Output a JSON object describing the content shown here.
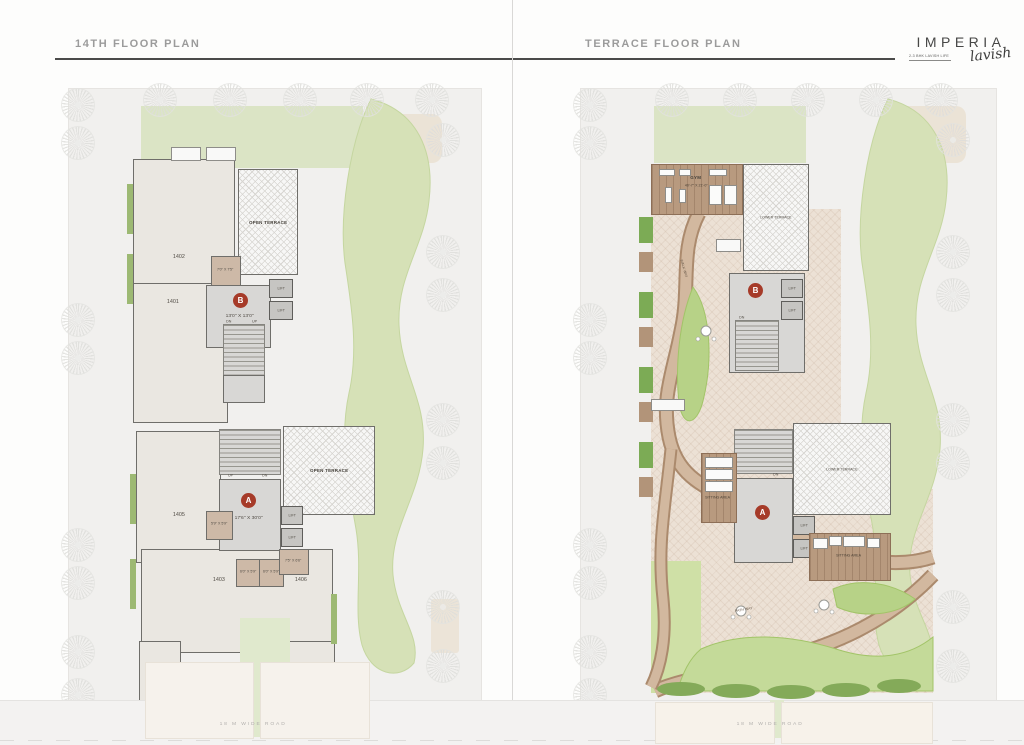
{
  "header": {
    "left_title": "14TH FLOOR PLAN",
    "right_title": "TERRACE  FLOOR PLAN"
  },
  "logo": {
    "brand": "IMPERIA",
    "tagline": "2-3 BHK LAVISH LIFE",
    "script": "lavish"
  },
  "accent_color": "#a63b29",
  "floor14": {
    "badge_b": "B",
    "badge_b_dims": "13'0\" X 13'0\"",
    "badge_a": "A",
    "badge_a_dims": "17'6\" X 30'0\"",
    "open_terrace_top": "OPEN TERRACE",
    "open_terrace_bottom": "OPEN TERRACE",
    "unit_1402": "1402",
    "unit_1401": "1401",
    "unit_1405": "1405",
    "unit_1403": "1403",
    "unit_1406": "1406",
    "store_b": "7'0\" X 7'5\"",
    "store_a": "5'9\" X 5'9\"",
    "store_c": "6'0\" X 5'9\"",
    "store_d": "6'0\" X 5'9\"",
    "store_e": "7'5\" X 6'6\"",
    "lift": "LIFT",
    "dn": "DN",
    "up": "UP",
    "road": "18 M WIDE ROAD"
  },
  "terrace": {
    "badge_b": "B",
    "badge_a": "A",
    "gym": "GYM",
    "gym_dims": "40'-7\" X 21'-0\"",
    "lower_terrace_b": "LOWER TERRACE",
    "lower_terrace_a": "LOWER TERRACE",
    "sitting_left": "SITTING AREA",
    "sitting_right": "SITTING AREA",
    "walk_way": "WALK WAY",
    "path_way": "PATH WAY",
    "lift": "LIFT",
    "dn": "DN",
    "road": "18 M WIDE ROAD"
  }
}
